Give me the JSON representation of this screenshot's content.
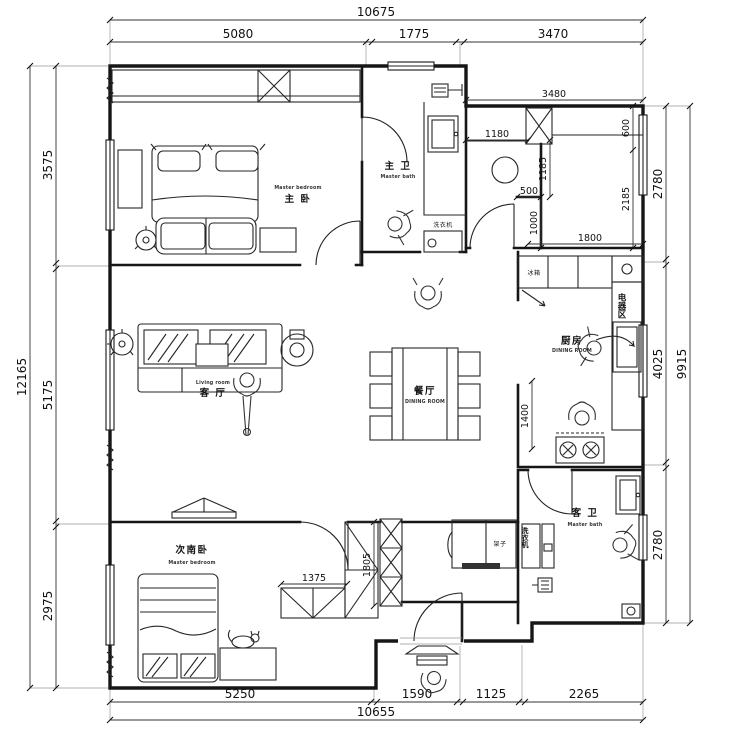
{
  "colors": {
    "line": "#161616",
    "dim_text": "#111111",
    "background": "#ffffff"
  },
  "dims": {
    "top": {
      "outer": "10675",
      "segments": [
        "5080",
        "1775",
        "3470"
      ]
    },
    "bottom": {
      "outer": "10655",
      "segments": [
        "5250",
        "1590",
        "1125",
        "2265"
      ]
    },
    "left": {
      "outer": "12165",
      "segments": [
        "3575",
        "5175",
        "2975"
      ]
    },
    "right": {
      "outer": "9915",
      "segments": [
        "2780",
        "4025",
        "2780"
      ]
    },
    "interior": {
      "storage_width": "3480",
      "storage_left_width": "1180",
      "storage_right_depth": "600",
      "shaft_upper_height": "1185",
      "shaft_width": "500",
      "shaft_lower_height": "1000",
      "ne_room_height": "2185",
      "ne_room_width": "1800",
      "kitchen_counter_length": "1400",
      "wardrobe_width": "1375",
      "wardrobe_depth": "1805"
    }
  },
  "rooms": {
    "master_bedroom": {
      "zh": "主 卧",
      "en": "Master bedroom"
    },
    "master_bath": {
      "zh": "主 卫",
      "en": "Master bath"
    },
    "living_room": {
      "zh": "客 厅",
      "en": "Living room"
    },
    "dining_room": {
      "zh": "餐厅",
      "en": "DINING ROOM"
    },
    "kitchen": {
      "zh": "厨房",
      "en": "DINING ROOM"
    },
    "appliance_zone": {
      "zh": "电器区"
    },
    "second_bedroom": {
      "zh": "次南卧",
      "en": "Master bedroom"
    },
    "guest_bath": {
      "zh": "客 卫",
      "en": "Master bath"
    }
  },
  "fixtures": {
    "washing_machine_master": "洗衣机",
    "washing_machine_guest": "洗衣机",
    "fridge": "冰箱",
    "shelf": "架子"
  }
}
